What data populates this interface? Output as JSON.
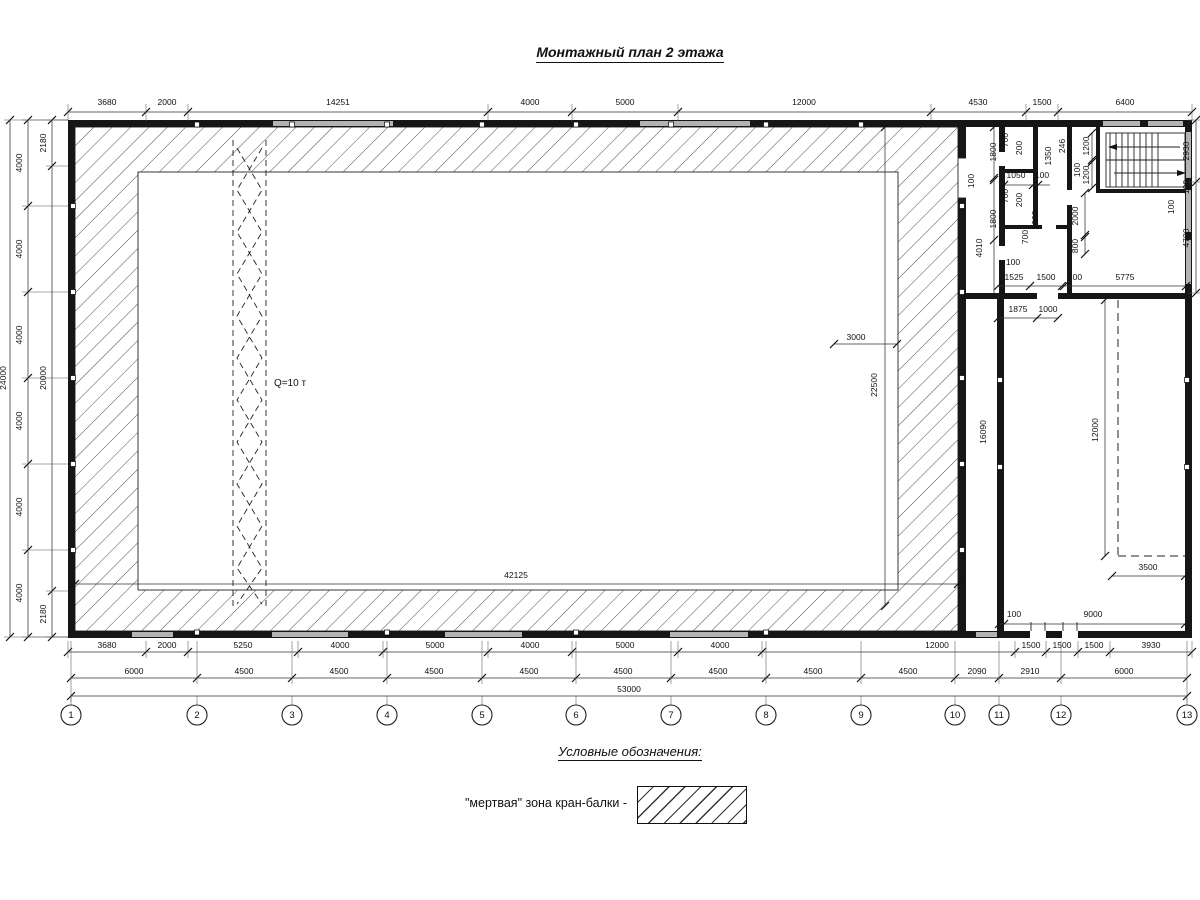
{
  "title": "Монтажный план 2 этажа",
  "legend": {
    "heading": "Условные обозначения:",
    "item_label": "\"мертвая\" зона кран-балки -"
  },
  "drawing": {
    "chains": [
      {
        "o": "h",
        "y": 112,
        "x1": 68,
        "x2": 1192,
        "ticks": [
          68,
          146,
          188,
          488,
          572,
          678,
          931,
          1026,
          1058,
          1192
        ],
        "ext": [
          104,
          121
        ]
      },
      {
        "o": "v",
        "x": 10,
        "y1": 120,
        "y2": 637,
        "ticks": [
          120,
          637
        ],
        "ext": [
          4,
          68
        ]
      },
      {
        "o": "v",
        "x": 28,
        "y1": 120,
        "y2": 637,
        "ticks": [
          120,
          206,
          292,
          378,
          464,
          550,
          637
        ],
        "ext": [
          22,
          68
        ]
      },
      {
        "o": "v",
        "x": 52,
        "y1": 120,
        "y2": 637,
        "ticks": [
          120,
          166,
          591,
          637
        ],
        "ext": [
          46,
          68
        ]
      },
      {
        "o": "h",
        "y": 652,
        "x1": 68,
        "x2": 1192,
        "ticks": [
          68,
          146,
          188,
          298,
          383,
          488,
          572,
          678,
          762,
          1015,
          1046,
          1078,
          1110,
          1192
        ],
        "ext": [
          641,
          658
        ]
      },
      {
        "o": "h",
        "y": 678,
        "x1": 71,
        "x2": 1187,
        "ticks": [
          71,
          197,
          292,
          387,
          482,
          576,
          671,
          766,
          861,
          955,
          999,
          1061,
          1187
        ],
        "ext": [
          641,
          684
        ]
      },
      {
        "o": "h",
        "y": 696,
        "x1": 71,
        "x2": 1187,
        "ticks": [
          71,
          1187
        ],
        "ext": [
          684,
          702
        ]
      },
      {
        "o": "v",
        "x": 1196,
        "y1": 120,
        "y2": 293,
        "ticks": [
          120,
          182,
          293
        ],
        "ext": [
          1188,
          1200
        ]
      },
      {
        "o": "h",
        "y": 286,
        "x1": 998,
        "x2": 1186,
        "ticks": [
          998,
          1030,
          1062,
          1064,
          1186
        ]
      },
      {
        "o": "h",
        "y": 318,
        "x1": 998,
        "x2": 1059,
        "ticks": [
          998,
          1037,
          1058
        ]
      },
      {
        "o": "h",
        "y": 584,
        "x1": 75,
        "x2": 958,
        "ticks": [
          75,
          958
        ]
      },
      {
        "o": "v",
        "x": 885,
        "y1": 127,
        "y2": 606,
        "ticks": [
          127,
          606
        ]
      },
      {
        "o": "h",
        "y": 344,
        "x1": 834,
        "x2": 897,
        "ticks": [
          834,
          897
        ]
      },
      {
        "o": "v",
        "x": 1105,
        "y1": 300,
        "y2": 556,
        "ticks": [
          300,
          556
        ]
      },
      {
        "o": "h",
        "y": 576,
        "x1": 1112,
        "x2": 1185,
        "ticks": [
          1112,
          1185
        ]
      },
      {
        "o": "h",
        "y": 624,
        "x1": 999,
        "x2": 1185,
        "ticks": [
          999,
          1004,
          1185
        ]
      },
      {
        "o": "h",
        "y": 185,
        "x1": 1004,
        "x2": 1050,
        "ticks": [
          1004,
          1033,
          1038
        ]
      },
      {
        "o": "v",
        "x": 1092,
        "y1": 133,
        "y2": 188,
        "ticks": [
          133,
          160,
          162,
          188
        ]
      },
      {
        "o": "v",
        "x": 1085,
        "y1": 193,
        "y2": 254,
        "ticks": [
          193,
          235,
          237,
          254
        ]
      },
      {
        "o": "v",
        "x": 994,
        "y1": 127,
        "y2": 293,
        "ticks": [
          127,
          178,
          180,
          240
        ]
      }
    ],
    "labels": [
      {
        "t": "3680",
        "x": 107,
        "y": 105
      },
      {
        "t": "2000",
        "x": 167,
        "y": 105
      },
      {
        "t": "14251",
        "x": 338,
        "y": 105
      },
      {
        "t": "4000",
        "x": 530,
        "y": 105
      },
      {
        "t": "5000",
        "x": 625,
        "y": 105
      },
      {
        "t": "12000",
        "x": 804,
        "y": 105
      },
      {
        "t": "4530",
        "x": 978,
        "y": 105
      },
      {
        "t": "1500",
        "x": 1042,
        "y": 105
      },
      {
        "t": "6400",
        "x": 1125,
        "y": 105
      },
      {
        "t": "24000",
        "x": 6,
        "y": 378,
        "r": 270
      },
      {
        "t": "4000",
        "x": 22,
        "y": 163,
        "r": 270
      },
      {
        "t": "4000",
        "x": 22,
        "y": 249,
        "r": 270
      },
      {
        "t": "4000",
        "x": 22,
        "y": 335,
        "r": 270
      },
      {
        "t": "4000",
        "x": 22,
        "y": 421,
        "r": 270
      },
      {
        "t": "4000",
        "x": 22,
        "y": 507,
        "r": 270
      },
      {
        "t": "4000",
        "x": 22,
        "y": 593,
        "r": 270
      },
      {
        "t": "2180",
        "x": 46,
        "y": 143,
        "r": 270
      },
      {
        "t": "20000",
        "x": 46,
        "y": 378,
        "r": 270
      },
      {
        "t": "2180",
        "x": 46,
        "y": 614,
        "r": 270
      },
      {
        "t": "3680",
        "x": 107,
        "y": 648
      },
      {
        "t": "2000",
        "x": 167,
        "y": 648
      },
      {
        "t": "5250",
        "x": 243,
        "y": 648
      },
      {
        "t": "4000",
        "x": 340,
        "y": 648
      },
      {
        "t": "5000",
        "x": 435,
        "y": 648
      },
      {
        "t": "4000",
        "x": 530,
        "y": 648
      },
      {
        "t": "5000",
        "x": 625,
        "y": 648
      },
      {
        "t": "4000",
        "x": 720,
        "y": 648
      },
      {
        "t": "12000",
        "x": 937,
        "y": 648
      },
      {
        "t": "1500",
        "x": 1031,
        "y": 648
      },
      {
        "t": "1500",
        "x": 1062,
        "y": 648
      },
      {
        "t": "1500",
        "x": 1094,
        "y": 648
      },
      {
        "t": "3930",
        "x": 1151,
        "y": 648
      },
      {
        "t": "6000",
        "x": 134,
        "y": 674
      },
      {
        "t": "4500",
        "x": 244,
        "y": 674
      },
      {
        "t": "4500",
        "x": 339,
        "y": 674
      },
      {
        "t": "4500",
        "x": 434,
        "y": 674
      },
      {
        "t": "4500",
        "x": 529,
        "y": 674
      },
      {
        "t": "4500",
        "x": 623,
        "y": 674
      },
      {
        "t": "4500",
        "x": 718,
        "y": 674
      },
      {
        "t": "4500",
        "x": 813,
        "y": 674
      },
      {
        "t": "4500",
        "x": 908,
        "y": 674
      },
      {
        "t": "2090",
        "x": 977,
        "y": 674
      },
      {
        "t": "2910",
        "x": 1030,
        "y": 674
      },
      {
        "t": "6000",
        "x": 1124,
        "y": 674
      },
      {
        "t": "53000",
        "x": 629,
        "y": 692
      },
      {
        "t": "2930",
        "x": 1189,
        "y": 151,
        "r": 270
      },
      {
        "t": "100",
        "x": 1189,
        "y": 187,
        "r": 270
      },
      {
        "t": "4780",
        "x": 1189,
        "y": 238,
        "r": 270
      },
      {
        "t": "3000",
        "x": 856,
        "y": 340
      },
      {
        "t": "22500",
        "x": 877,
        "y": 385,
        "r": 270
      },
      {
        "t": "42125",
        "x": 516,
        "y": 578
      },
      {
        "t": "Q=10 т",
        "x": 290,
        "y": 386,
        "s": "big"
      },
      {
        "t": "1800",
        "x": 996,
        "y": 152,
        "r": 270
      },
      {
        "t": "100",
        "x": 974,
        "y": 181,
        "r": 270
      },
      {
        "t": "1800",
        "x": 996,
        "y": 219,
        "r": 270
      },
      {
        "t": "4010",
        "x": 982,
        "y": 248,
        "r": 270
      },
      {
        "t": "1050",
        "x": 1016,
        "y": 178
      },
      {
        "t": "100",
        "x": 1042,
        "y": 178
      },
      {
        "t": "700",
        "x": 1008,
        "y": 140,
        "r": 270
      },
      {
        "t": "200",
        "x": 1022,
        "y": 148,
        "r": 270
      },
      {
        "t": "1350",
        "x": 1051,
        "y": 156,
        "r": 270
      },
      {
        "t": "246",
        "x": 1065,
        "y": 146,
        "r": 270
      },
      {
        "t": "700",
        "x": 1008,
        "y": 196,
        "r": 270
      },
      {
        "t": "200",
        "x": 1022,
        "y": 200,
        "r": 270
      },
      {
        "t": "700",
        "x": 1028,
        "y": 237,
        "r": 270
      },
      {
        "t": "1000",
        "x": 1038,
        "y": 220,
        "r": 270
      },
      {
        "t": "2000",
        "x": 1078,
        "y": 216,
        "r": 270
      },
      {
        "t": "800",
        "x": 1078,
        "y": 246,
        "r": 270
      },
      {
        "t": "1200",
        "x": 1089,
        "y": 146,
        "r": 270
      },
      {
        "t": "100",
        "x": 1080,
        "y": 170,
        "r": 270
      },
      {
        "t": "1200",
        "x": 1089,
        "y": 175,
        "r": 270
      },
      {
        "t": "100",
        "x": 1174,
        "y": 207,
        "r": 270
      },
      {
        "t": "100",
        "x": 1013,
        "y": 265
      },
      {
        "t": "1525",
        "x": 1014,
        "y": 280
      },
      {
        "t": "1500",
        "x": 1046,
        "y": 280
      },
      {
        "t": "100",
        "x": 1075,
        "y": 280
      },
      {
        "t": "5775",
        "x": 1125,
        "y": 280
      },
      {
        "t": "1875",
        "x": 1018,
        "y": 312
      },
      {
        "t": "1000",
        "x": 1048,
        "y": 312
      },
      {
        "t": "16090",
        "x": 986,
        "y": 432,
        "r": 270
      },
      {
        "t": "12000",
        "x": 1098,
        "y": 430,
        "r": 270
      },
      {
        "t": "3500",
        "x": 1148,
        "y": 570
      },
      {
        "t": "100",
        "x": 1014,
        "y": 617
      },
      {
        "t": "9000",
        "x": 1093,
        "y": 617
      }
    ],
    "grid_bubbles": {
      "y": 715,
      "r": 10,
      "items": [
        {
          "n": "1",
          "x": 71
        },
        {
          "n": "2",
          "x": 197
        },
        {
          "n": "3",
          "x": 292
        },
        {
          "n": "4",
          "x": 387
        },
        {
          "n": "5",
          "x": 482
        },
        {
          "n": "6",
          "x": 576
        },
        {
          "n": "7",
          "x": 671
        },
        {
          "n": "8",
          "x": 766
        },
        {
          "n": "9",
          "x": 861
        },
        {
          "n": "10",
          "x": 955
        },
        {
          "n": "11",
          "x": 999
        },
        {
          "n": "12",
          "x": 1061
        },
        {
          "n": "13",
          "x": 1187
        }
      ]
    }
  }
}
